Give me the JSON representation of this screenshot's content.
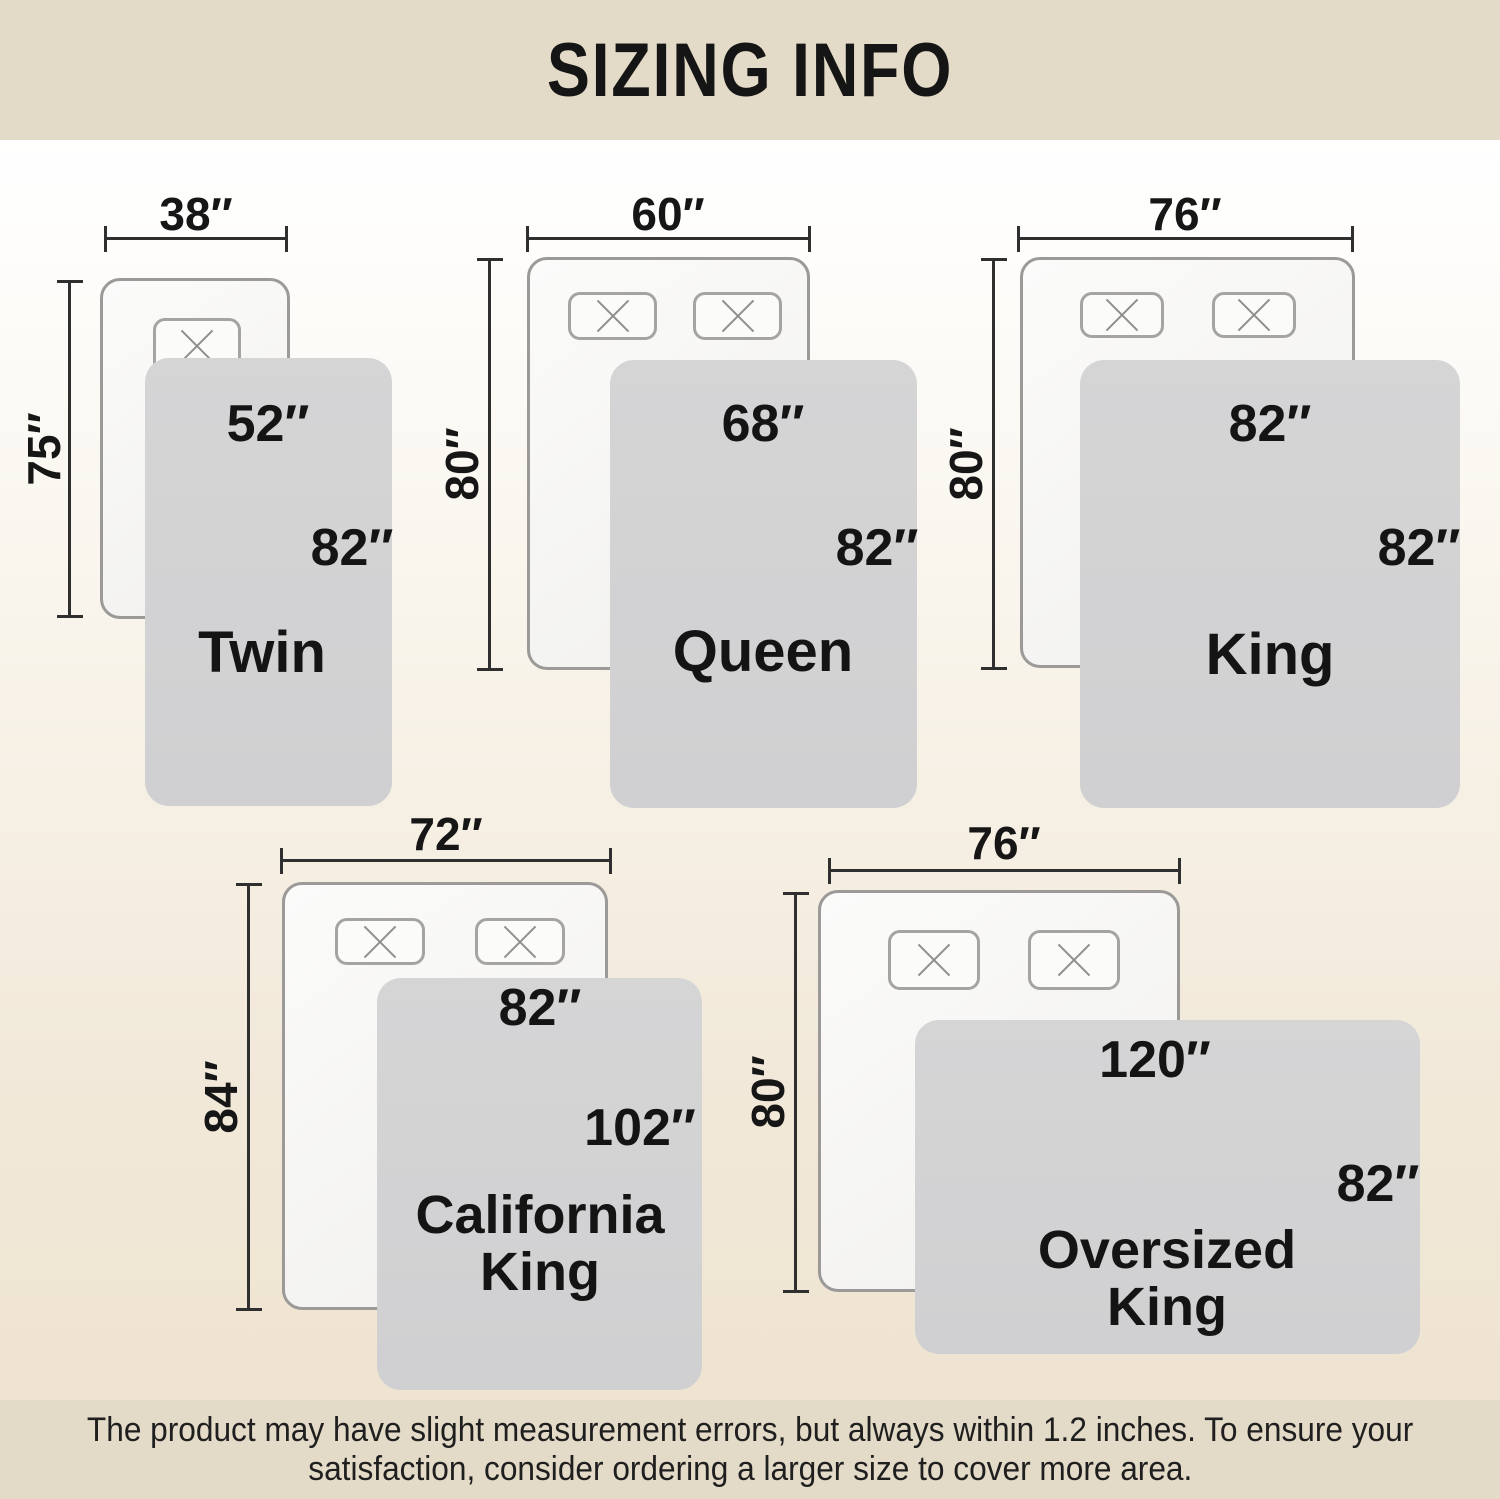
{
  "header": {
    "title": "SIZING INFO"
  },
  "sizes": [
    {
      "name_line1": "Twin",
      "bed_width": "38″",
      "bed_length": "75″",
      "blanket_width": "52″",
      "blanket_length": "82″"
    },
    {
      "name_line1": "Queen",
      "bed_width": "60″",
      "bed_length": "80″",
      "blanket_width": "68″",
      "blanket_length": "82″"
    },
    {
      "name_line1": "King",
      "bed_width": "76″",
      "bed_length": "80″",
      "blanket_width": "82″",
      "blanket_length": "82″"
    },
    {
      "name_line1": "California",
      "name_line2": "King",
      "bed_width": "72″",
      "bed_length": "84″",
      "blanket_width": "82″",
      "blanket_length": "102″"
    },
    {
      "name_line1": "Oversized",
      "name_line2": "King",
      "bed_width": "76″",
      "bed_length": "80″",
      "blanket_width": "120″",
      "blanket_length": "82″"
    }
  ],
  "footer": {
    "line1": "The product may have slight measurement errors, but always within 1.2 inches. To ensure your",
    "line2": "satisfaction, consider ordering a larger size to cover more area."
  },
  "colors": {
    "band_background": "#e3dac7",
    "body_gradient_top": "#ffffff",
    "body_gradient_bottom": "#eee3d0",
    "bed_fill": "#f7f6f4",
    "bed_border": "#9b9a98",
    "pillow_border": "#a5a4a2",
    "blanket_fill": "#d3d3d4",
    "text": "#161616",
    "dimension_line": "#2f2f2f"
  }
}
